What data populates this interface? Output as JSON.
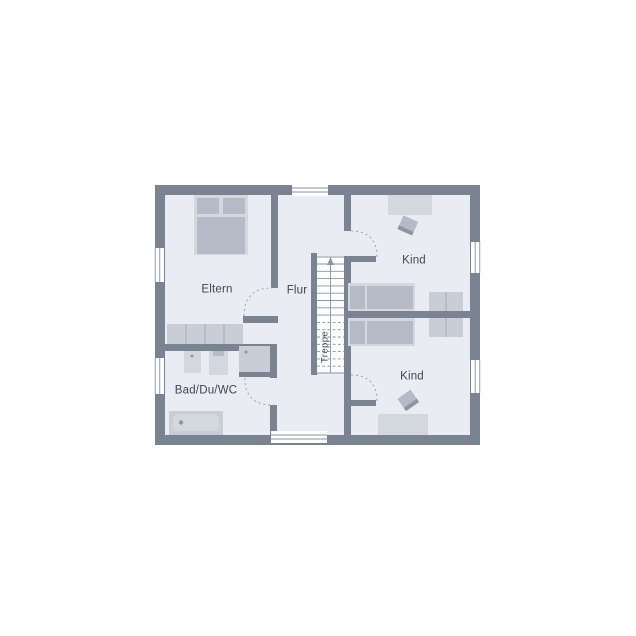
{
  "floorplan": {
    "rooms": [
      {
        "id": "eltern",
        "label": "Eltern"
      },
      {
        "id": "flur",
        "label": "Flur"
      },
      {
        "id": "kind-top",
        "label": "Kind"
      },
      {
        "id": "kind-bottom",
        "label": "Kind"
      },
      {
        "id": "bad",
        "label": "Bad/Du/WC"
      },
      {
        "id": "treppe",
        "label": "Treppe"
      }
    ],
    "colors": {
      "wall": "#7a8391",
      "floor": "#e9ecf2",
      "background": "#ffffff",
      "furniture_light": "#d3d7de",
      "furniture_mid": "#b5bbc6",
      "furniture_soft": "#c9ced6",
      "window_frame": "#b0b6c0",
      "door_arc": "#a0a8b3",
      "stair_line": "#8d95a2",
      "label_text": "#3e4554"
    }
  }
}
